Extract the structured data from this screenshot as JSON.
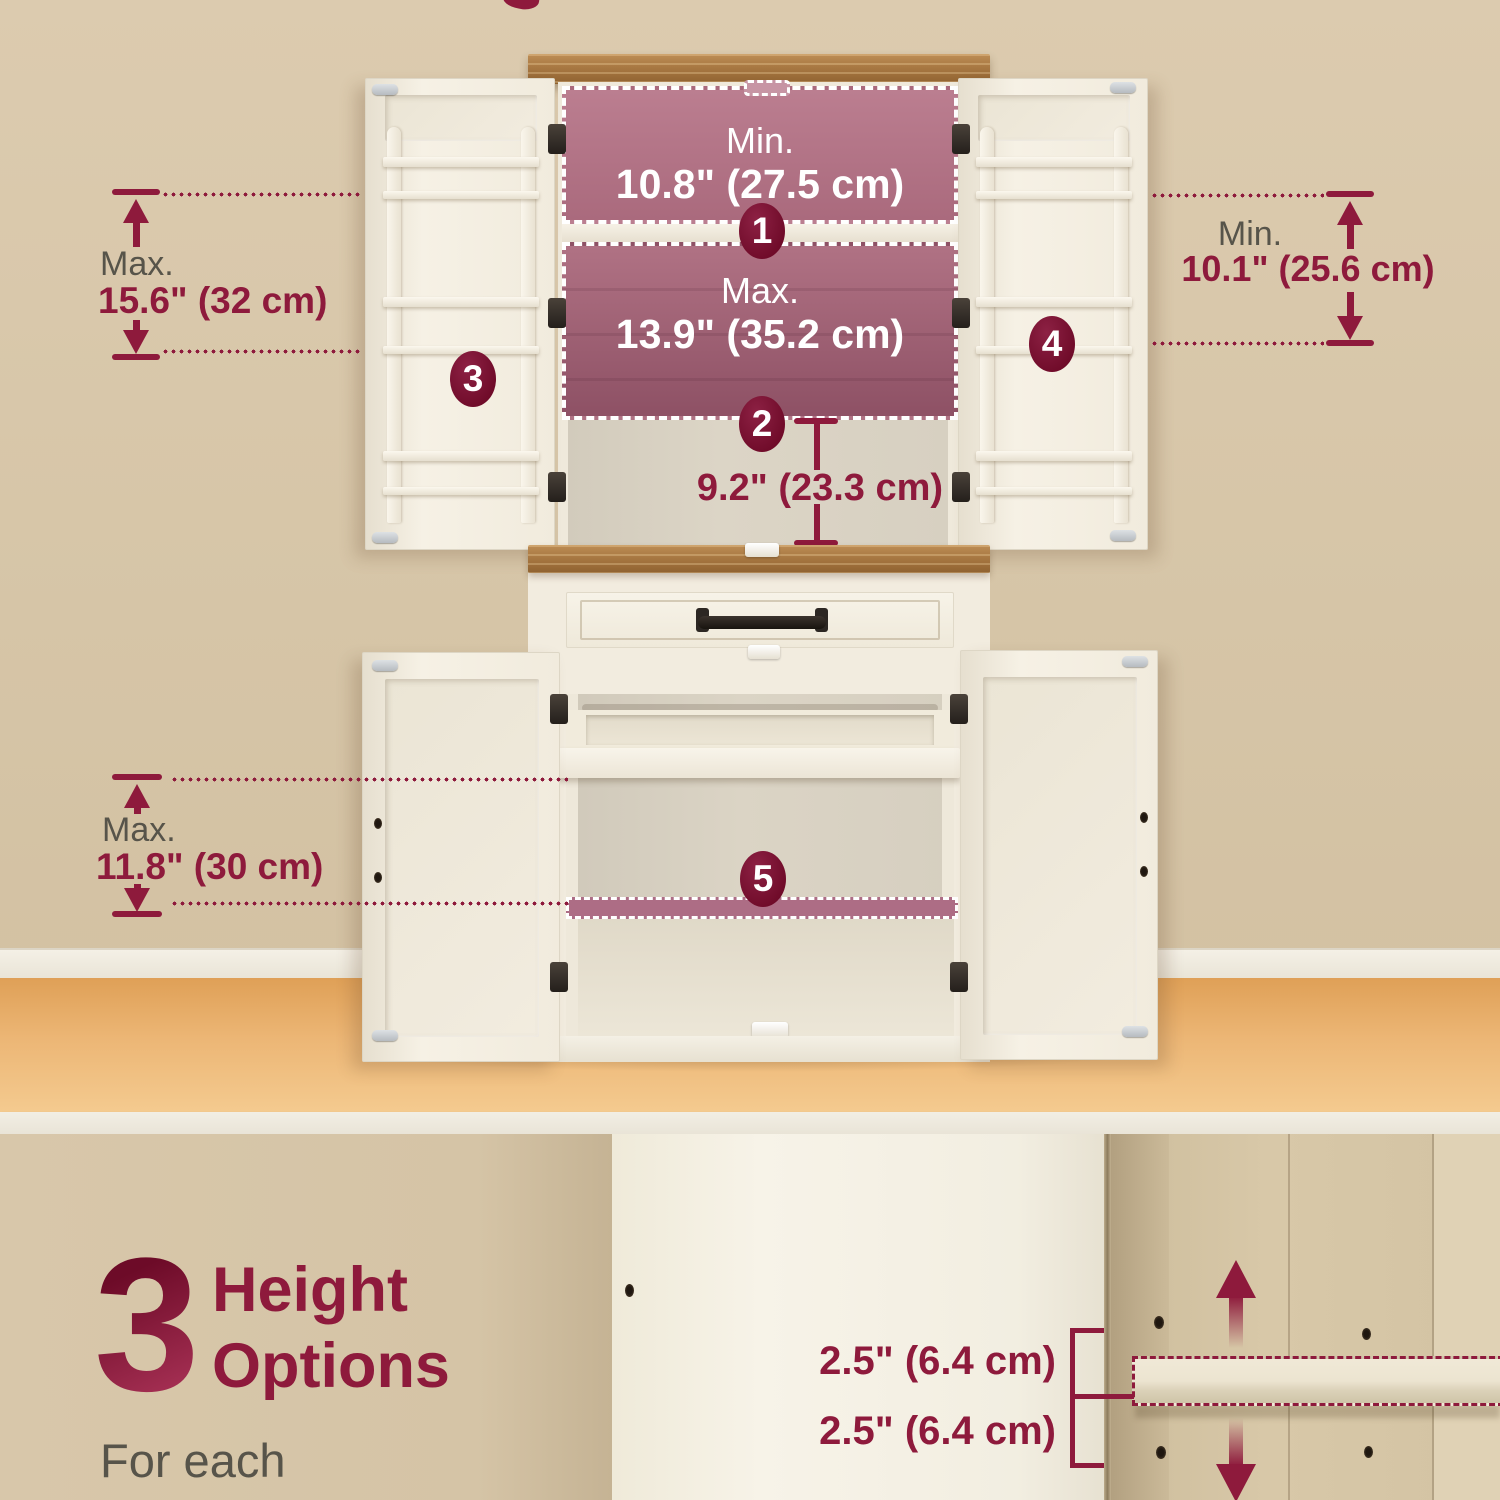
{
  "annotations": {
    "marker1": "1",
    "marker2": "2",
    "marker3": "3",
    "marker4": "4",
    "marker5": "5",
    "slot1_label": "Min.",
    "slot1_value": "10.8\" (27.5 cm)",
    "slot2_label": "Max.",
    "slot2_value": "13.9\" (35.2 cm)",
    "gap_value": "9.2\" (23.3 cm)",
    "left_label": "Max.",
    "left_value": "15.6\" (32 cm)",
    "right_label": "Min.",
    "right_value": "10.1\" (25.6 cm)",
    "base_label": "Max.",
    "base_value": "11.8\" (30 cm)"
  },
  "detail_panel": {
    "big_number": "3",
    "title_line1": "Height",
    "title_line2": "Options",
    "subtitle_line1": "For each",
    "subtitle_line2": "adjustable shelf",
    "measure_top": "2.5\" (6.4 cm)",
    "measure_bottom": "2.5\" (6.4 cm)"
  },
  "colors": {
    "accent": "#8e1a3c",
    "marker": "#7a0e2e",
    "highlight_pink": "#ad6d82",
    "wall": "#d8c7a9",
    "floor": "#eab06d",
    "cabinet_white": "#f3eee2",
    "wood_top": "#a97a42",
    "label_gray": "#57544a"
  }
}
